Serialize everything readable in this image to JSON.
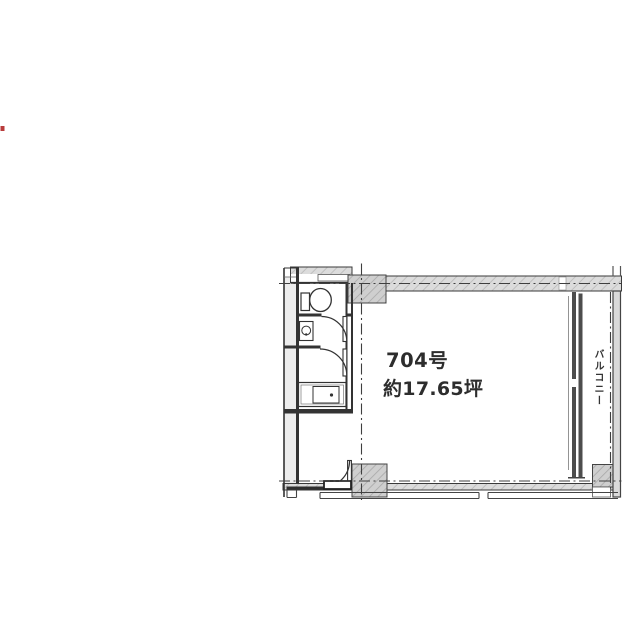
{
  "marker": {
    "color": "#b83b3b"
  },
  "floor_plan": {
    "unit_label": "704号",
    "area_label": "約17.65坪",
    "balcony_label": "バルコニー",
    "colors": {
      "line": "#3a3a3a",
      "wall_hatch_fill": "#dcdcdc",
      "column_hatch_fill": "#cfcfcf",
      "window_wall": "#4d4d4d",
      "label_text": "#2d2d2d"
    },
    "icons": [
      "toilet-icon",
      "washbasin-icon",
      "kitchen-sink-icon",
      "door-swing-arc",
      "balcony-railing"
    ]
  }
}
